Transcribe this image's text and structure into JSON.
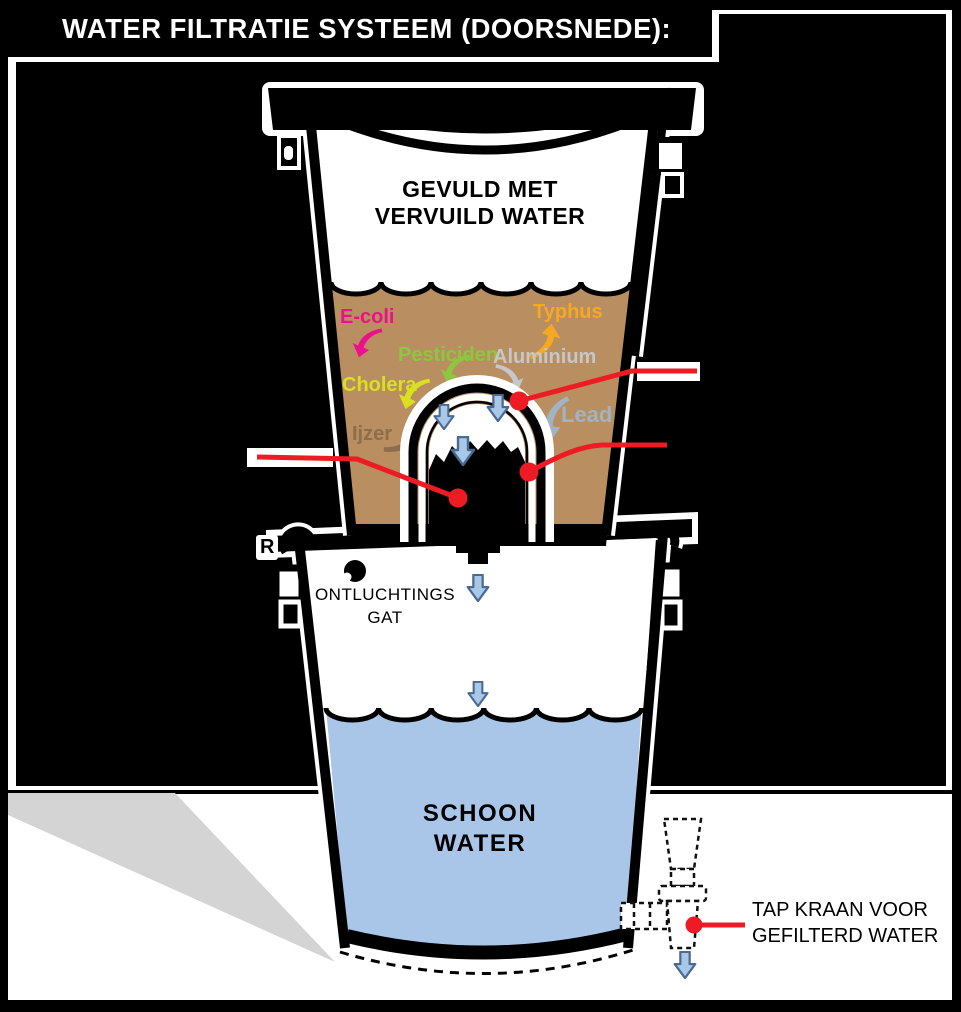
{
  "title": "WATER FILTRATIE SYSTEEM (DOORSNEDE):",
  "upper_bucket": {
    "label_line1": "GEVULD MET",
    "label_line2": "VERVUILD WATER"
  },
  "contaminants": {
    "ecoli": {
      "label": "E-coli",
      "color": "#ec108c"
    },
    "typhus": {
      "label": "Typhus",
      "color": "#f7a823"
    },
    "pesticiden": {
      "label": "Pesticiden",
      "color": "#8dc63f"
    },
    "aluminium": {
      "label": "Aluminium",
      "color": "#c4c8cc"
    },
    "cholera": {
      "label": "Cholera",
      "color": "#d9e021"
    },
    "lead": {
      "label": "Lead",
      "color": "#a2b4c4"
    },
    "ijzer": {
      "label": "Ijzer",
      "color": "#8c6d4c"
    }
  },
  "lower_bucket": {
    "vent_label_line1": "ONTLUCHTINGS",
    "vent_label_line2": "GAT",
    "water_label_line1": "SCHOON",
    "water_label_line2": "WATER",
    "stray_letter": "R"
  },
  "tap": {
    "label_line1": "TAP KRAAN VOOR",
    "label_line2": "GEFILTERD WATER"
  },
  "palette": {
    "dirty_water": "#b98e60",
    "clean_water": "#a9c5e8",
    "arrow_fill": "#a9c8e8",
    "arrow_stroke": "#4a6a92",
    "callout_red": "#ed1c24",
    "shadow_gray": "#d4d4d4",
    "ink": "#000000",
    "paper": "#ffffff"
  }
}
